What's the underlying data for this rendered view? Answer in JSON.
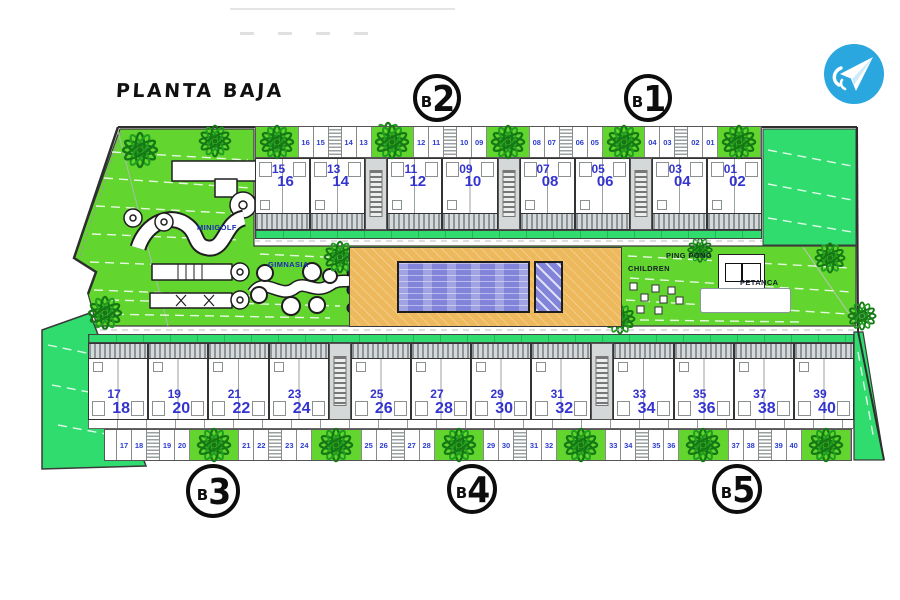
{
  "title": "PLANTA BAJA",
  "logo": {
    "icon": "paper-plane-icon",
    "bg_color": "#2ba7df"
  },
  "blocks": {
    "b1": {
      "prefix": "B",
      "digit": "1"
    },
    "b2": {
      "prefix": "B",
      "digit": "2"
    },
    "b3": {
      "prefix": "B",
      "digit": "3"
    },
    "b4": {
      "prefix": "B",
      "digit": "4"
    },
    "b5": {
      "prefix": "B",
      "digit": "5"
    }
  },
  "amenities": {
    "minigolf": "MINIGOLF",
    "gimnasia": "GIMNASIA",
    "children": "CHILDREN",
    "ping_pong": "PING PONG",
    "petanca": "PETANCA"
  },
  "top_row": {
    "band": [
      {
        "type": "planter"
      },
      {
        "type": "num",
        "label": "16"
      },
      {
        "type": "num",
        "label": "15"
      },
      {
        "type": "stair"
      },
      {
        "type": "num",
        "label": "14"
      },
      {
        "type": "num",
        "label": "13"
      },
      {
        "type": "planter"
      },
      {
        "type": "num",
        "label": "12"
      },
      {
        "type": "num",
        "label": "11"
      },
      {
        "type": "stair"
      },
      {
        "type": "num",
        "label": "10"
      },
      {
        "type": "num",
        "label": "09"
      },
      {
        "type": "planter"
      },
      {
        "type": "num",
        "label": "08"
      },
      {
        "type": "num",
        "label": "07"
      },
      {
        "type": "stair"
      },
      {
        "type": "num",
        "label": "06"
      },
      {
        "type": "num",
        "label": "05"
      },
      {
        "type": "planter"
      },
      {
        "type": "num",
        "label": "04"
      },
      {
        "type": "num",
        "label": "03"
      },
      {
        "type": "stair"
      },
      {
        "type": "num",
        "label": "02"
      },
      {
        "type": "num",
        "label": "01"
      },
      {
        "type": "planter"
      }
    ],
    "modules": [
      {
        "type": "module",
        "upper": "15",
        "lower": "16"
      },
      {
        "type": "module",
        "upper": "13",
        "lower": "14"
      },
      {
        "type": "corridor"
      },
      {
        "type": "module",
        "upper": "11",
        "lower": "12"
      },
      {
        "type": "module",
        "upper": "09",
        "lower": "10"
      },
      {
        "type": "corridor"
      },
      {
        "type": "module",
        "upper": "07",
        "lower": "08"
      },
      {
        "type": "module",
        "upper": "05",
        "lower": "06"
      },
      {
        "type": "corridor"
      },
      {
        "type": "module",
        "upper": "03",
        "lower": "04"
      },
      {
        "type": "module",
        "upper": "01",
        "lower": "02"
      }
    ]
  },
  "bottom_row": {
    "modules": [
      {
        "type": "module",
        "upper": "17",
        "lower": "18"
      },
      {
        "type": "module",
        "upper": "19",
        "lower": "20"
      },
      {
        "type": "module",
        "upper": "21",
        "lower": "22"
      },
      {
        "type": "module",
        "upper": "23",
        "lower": "24"
      },
      {
        "type": "corridor"
      },
      {
        "type": "module",
        "upper": "25",
        "lower": "26"
      },
      {
        "type": "module",
        "upper": "27",
        "lower": "28"
      },
      {
        "type": "module",
        "upper": "29",
        "lower": "30"
      },
      {
        "type": "module",
        "upper": "31",
        "lower": "32"
      },
      {
        "type": "corridor"
      },
      {
        "type": "module",
        "upper": "33",
        "lower": "34"
      },
      {
        "type": "module",
        "upper": "35",
        "lower": "36"
      },
      {
        "type": "module",
        "upper": "37",
        "lower": "38"
      },
      {
        "type": "module",
        "upper": "39",
        "lower": "40"
      }
    ],
    "band": [
      {
        "type": "blank"
      },
      {
        "type": "num",
        "label": "17"
      },
      {
        "type": "num",
        "label": "18"
      },
      {
        "type": "stair"
      },
      {
        "type": "num",
        "label": "19"
      },
      {
        "type": "num",
        "label": "20"
      },
      {
        "type": "planter"
      },
      {
        "type": "num",
        "label": "21"
      },
      {
        "type": "num",
        "label": "22"
      },
      {
        "type": "stair"
      },
      {
        "type": "num",
        "label": "23"
      },
      {
        "type": "num",
        "label": "24"
      },
      {
        "type": "planter"
      },
      {
        "type": "num",
        "label": "25"
      },
      {
        "type": "num",
        "label": "26"
      },
      {
        "type": "stair"
      },
      {
        "type": "num",
        "label": "27"
      },
      {
        "type": "num",
        "label": "28"
      },
      {
        "type": "planter"
      },
      {
        "type": "num",
        "label": "29"
      },
      {
        "type": "num",
        "label": "30"
      },
      {
        "type": "stair"
      },
      {
        "type": "num",
        "label": "31"
      },
      {
        "type": "num",
        "label": "32"
      },
      {
        "type": "planter"
      },
      {
        "type": "num",
        "label": "33"
      },
      {
        "type": "num",
        "label": "34"
      },
      {
        "type": "stair"
      },
      {
        "type": "num",
        "label": "35"
      },
      {
        "type": "num",
        "label": "36"
      },
      {
        "type": "planter"
      },
      {
        "type": "num",
        "label": "37"
      },
      {
        "type": "num",
        "label": "38"
      },
      {
        "type": "stair"
      },
      {
        "type": "num",
        "label": "39"
      },
      {
        "type": "num",
        "label": "40"
      },
      {
        "type": "planter"
      }
    ]
  },
  "colors": {
    "grass_yellow_green": "#62d52f",
    "grass_emerald": "#2fdc6d",
    "deck_sand": "#edb95c",
    "pool_blue": "#8184d8",
    "unit_number_blue": "#3434cf",
    "parking_number_blue": "#2b3bd0",
    "logo_blue": "#2ba7df",
    "plant_green": "#157815"
  }
}
